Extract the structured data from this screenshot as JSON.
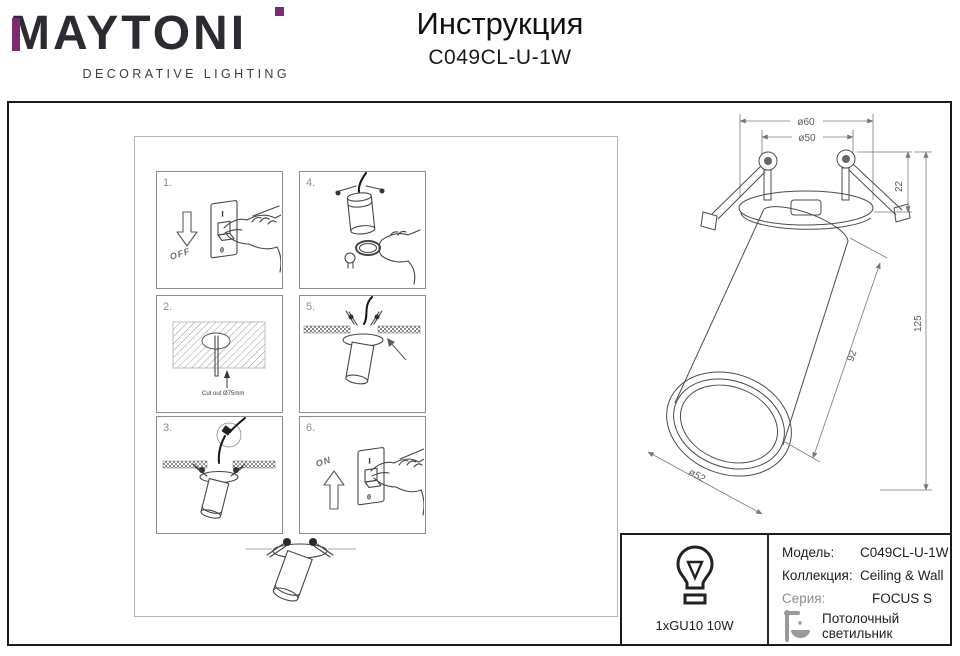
{
  "header": {
    "brand": "MAYTONI",
    "brand_tagline": "DECORATIVE LIGHTING",
    "doc_title": "Инструкция",
    "doc_model": "C049CL-U-1W",
    "accent_color": "#7c2b6e"
  },
  "steps": {
    "s1": {
      "num": "1.",
      "label": "OFF"
    },
    "s2": {
      "num": "2.",
      "label": "Cut out Ø75mm"
    },
    "s3": {
      "num": "3."
    },
    "s4": {
      "num": "4."
    },
    "s5": {
      "num": "5."
    },
    "s6": {
      "num": "6.",
      "label": "ON"
    }
  },
  "switch_glyphs": {
    "top": "I",
    "bottom": "0"
  },
  "drawing_dimensions": {
    "outer_diameter": "ø60",
    "inner_diameter": "ø50",
    "recess_height": "22",
    "total_height": "125",
    "body_length": "92",
    "face_diameter": "ø52"
  },
  "specs": {
    "bulb": "1xGU10 10W",
    "model_label": "Модель:",
    "model_value": "C049CL-U-1W",
    "collection_label": "Коллекция:",
    "collection_value": "Ceiling & Wall",
    "series_label": "Серия:",
    "series_value": "FOCUS S",
    "type_value": "Потолочный светильник"
  }
}
